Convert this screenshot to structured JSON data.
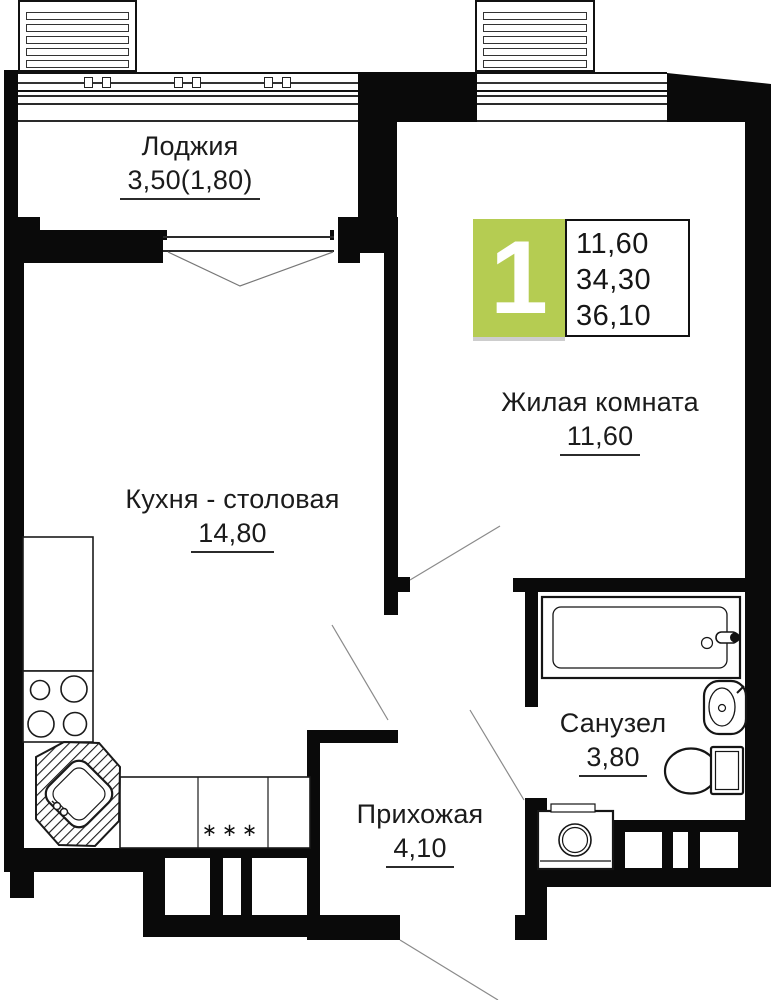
{
  "plan": {
    "badge": {
      "number": "1",
      "areas": [
        "11,60",
        "34,30",
        "36,10"
      ],
      "green_color": "#b5cc52"
    },
    "rooms": {
      "loggia": {
        "name": "Лоджия",
        "area": "3,50(1,80)"
      },
      "living": {
        "name": "Жилая комната",
        "area": "11,60"
      },
      "kitchen": {
        "name": "Кухня - столовая",
        "area": "14,80"
      },
      "hallway": {
        "name": "Прихожая",
        "area": "4,10"
      },
      "bathroom": {
        "name": "Санузел",
        "area": "3,80"
      }
    },
    "kitchen_marks": "∗∗∗"
  }
}
